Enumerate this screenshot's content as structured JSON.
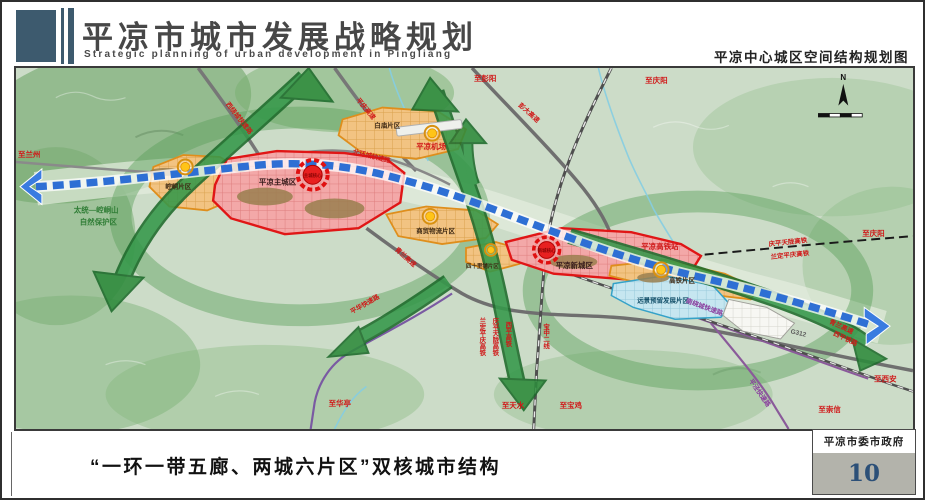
{
  "header": {
    "title": "平凉市城市发展战略规划",
    "subtitle": "Strategic planning of urban development in Pingliang",
    "map_caption": "平凉中心城区空间结构规划图"
  },
  "map": {
    "zones": {
      "kongtong": "崆峒片区",
      "baimiao": "白庙片区",
      "main_city": "平凉主城区",
      "logistics": "商贸物流片区",
      "sishilipu": "四十里铺片区",
      "new_city": "平凉新城区",
      "hsr": "高铁片区",
      "reserve": "远景预留发展片区"
    },
    "cores": {
      "main": "主城核心",
      "new": "新城核心"
    },
    "stations": {
      "airport": "平凉机场",
      "hsr_station": "平凉高铁站"
    },
    "nature": {
      "line1": "太统—崆峒山",
      "line2": "自然保护区"
    },
    "roads": {
      "west_ring": "西绕城快速路",
      "north_ring": "北环城快速路",
      "south_ring": "南绕城快速路",
      "pingqing_expwy": "平庆高速",
      "pengda_expwy": "彭大高速",
      "qinglan_expwy": "青兰高速",
      "qinglan_expwy_east": "青兰高速",
      "pinghua_rd": "平华快速路",
      "pingjing_rd": "平泾快速路",
      "g312": "G312"
    },
    "rails": {
      "qingping_hsr": "庆平天陇高铁",
      "landing_hsr": "兰定平庆高铁",
      "qingping_hsr_v": "庆平天陇高铁",
      "landing_hsr_v": "兰定平庆高铁",
      "xiping_hsr_v": "西平高铁",
      "baozhong_line": "宝中二线",
      "xiping_rail_east": "西平铁路"
    },
    "destinations": {
      "lanzhou": "至兰州",
      "pengyang": "至彭阳",
      "qingyang_top": "至庆阳",
      "qingyang_right": "至庆阳",
      "xian": "至西安",
      "chongxin": "至崇信",
      "huating": "至华亭",
      "tianshui": "至天水",
      "baoji": "至宝鸡"
    },
    "compass": "N"
  },
  "footer": {
    "caption": "“一环一带五廊、两城六片区”双核城市结构",
    "agency": "平凉市委市政府",
    "page_number": "10"
  },
  "colors": {
    "ribbon_blue": "#2e6fd4",
    "corridor_green": "#2e8b3c",
    "zone_red": "#e01616",
    "zone_orange": "#df8e1c",
    "reserve_blue": "#35a2c8",
    "subcenter_yellow": "#ffc418",
    "core_red": "#e82020",
    "label_red": "#d01818",
    "header_blue": "#3d5a6e",
    "page_number_blue": "#2c5078"
  }
}
